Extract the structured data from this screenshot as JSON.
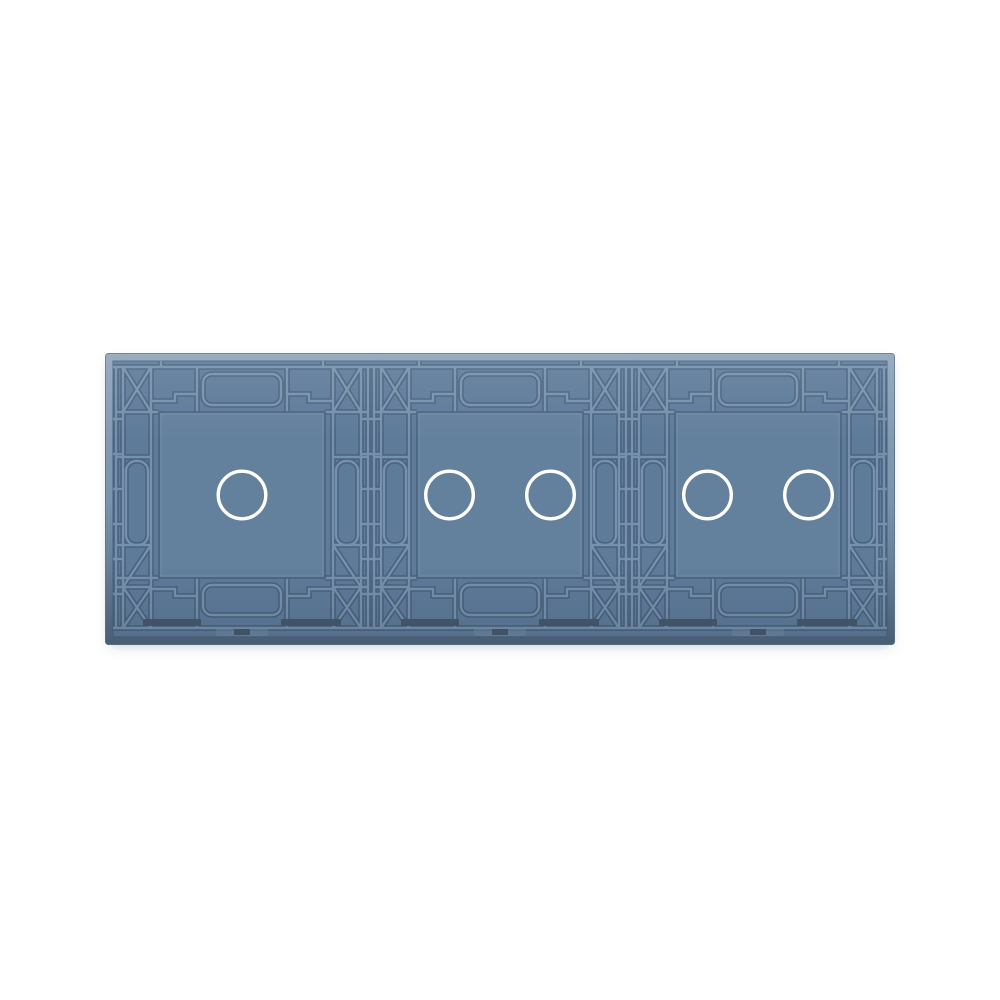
{
  "page": {
    "background": "#ffffff"
  },
  "panel": {
    "description": "Back side of a blue plastic-and-glass touch light switch panel with molded reinforcement ribs, three switch modules in a row",
    "orientation": "horizontal triple gang, rear view",
    "colors": {
      "page-bg": "#ffffff",
      "rimtop": "#8ea4ba",
      "rimmid": "#7b93ac",
      "rimbottom": "#51687f",
      "field": "#5e7b9a",
      "square": "#63809c",
      "ribdark": "#48627f",
      "riblight": "#7691ad",
      "slot": "#465a6e",
      "edge": "#5f7890"
    },
    "modules": [
      {
        "id": "module-1",
        "touch_points": 1
      },
      {
        "id": "module-2",
        "touch_points": 2
      },
      {
        "id": "module-3",
        "touch_points": 2
      }
    ],
    "touch_ring": {
      "icon": "touch-ring-icon",
      "color": "#ffffff",
      "radius": 23.8,
      "stroke_width": 3.4,
      "pair_spacing": 101
    }
  }
}
